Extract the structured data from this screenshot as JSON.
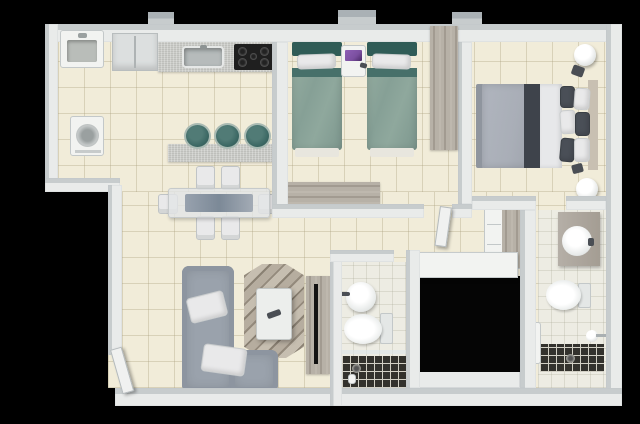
{
  "scene": {
    "type": "3d-floorplan-top-view",
    "description": "Two-bedroom apartment 3D floor plan render on black background",
    "rooms": [
      {
        "id": "laundry",
        "furniture": [
          "utility-sink",
          "washing-machine"
        ]
      },
      {
        "id": "kitchen",
        "furniture": [
          "refrigerator",
          "counter-with-sink",
          "cooktop",
          "breakfast-bar",
          "bar-stool",
          "bar-stool",
          "bar-stool"
        ]
      },
      {
        "id": "dining-area",
        "furniture": [
          "dining-table",
          "chair",
          "chair",
          "chair",
          "chair",
          "chair",
          "chair"
        ]
      },
      {
        "id": "living-room",
        "furniture": [
          "l-shaped-sofa",
          "throw-pillow",
          "throw-pillow",
          "hex-pattern-rug",
          "coffee-table",
          "tv-panel"
        ]
      },
      {
        "id": "twin-bedroom",
        "furniture": [
          "twin-bed",
          "twin-bed",
          "nightstand",
          "laptop",
          "wardrobe",
          "dresser"
        ]
      },
      {
        "id": "master-bedroom",
        "furniture": [
          "double-bed",
          "round-nightstand",
          "round-nightstand",
          "wardrobe"
        ]
      },
      {
        "id": "social-bathroom",
        "furniture": [
          "washbasin",
          "toilet",
          "shower"
        ]
      },
      {
        "id": "ensuite-bathroom",
        "furniture": [
          "vanity-washbasin",
          "toilet",
          "shower",
          "glass-door"
        ]
      }
    ]
  },
  "colors": {
    "bg": "#000000",
    "black_void": "#050505",
    "wall_face": "#e9ebea",
    "wall_top": "#c7cccd",
    "wall_shade": "#aab1b5",
    "floor": "#f1ecd9",
    "floor_line": "#a89e7c59",
    "bath_floor": "#edece3",
    "bath_floor_line": "#a0a08c40",
    "granite": "#cbccc8",
    "wood_a": "#b7b1a7",
    "wood_b": "#a29b91",
    "teal_dark": "#305c57",
    "teal_mid": "#47706a",
    "teal_blanket": "#8ca69c",
    "teal_stool": "#3c6864",
    "sofa": "#9aa2ac",
    "fabric_white": "#e9e9ea",
    "bed_gray": "#a9aeb7",
    "bed_dark": "#3e434b",
    "duvet": "#e7e8ea",
    "headboard_wood": "#c8c0b2",
    "tile_dark": "#33322d",
    "tile_line": "#d2d0c5",
    "appliance": "#dcdfdf",
    "steel": "#b6bbbb",
    "stove": "#1f1f1f",
    "burner": "#4a4a4a",
    "laptop": "#7b4fa0",
    "white_fixture": "#f2f3f1"
  }
}
